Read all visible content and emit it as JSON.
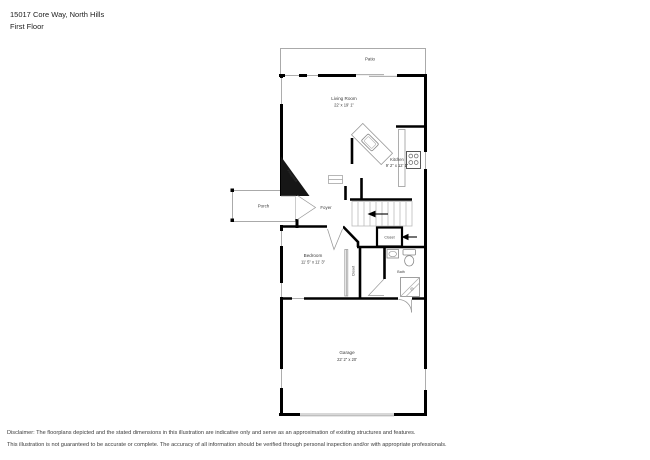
{
  "header": {
    "address": "15017 Core Way, North Hills",
    "floor": "First Floor"
  },
  "rooms": {
    "patio": {
      "label": "Patio"
    },
    "living_room": {
      "label": "Living Room",
      "dims": "22' x 19' 1\""
    },
    "kitchen": {
      "label": "Kitchen",
      "dims": "9' 2\" x 12' 1\""
    },
    "porch": {
      "label": "Porch"
    },
    "foyer": {
      "label": "Foyer"
    },
    "fireplace": {
      "label": "Fireplace"
    },
    "stair_closet": {
      "label": "Closet"
    },
    "bedroom": {
      "label": "Bedroom",
      "dims": "11' 5\" x 11' 3\""
    },
    "bedroom_closet": {
      "label": "Closet"
    },
    "bath": {
      "label": "Bath"
    },
    "garage": {
      "label": "Garage",
      "dims": "22' 2\" x 20'"
    }
  },
  "disclaimer": {
    "line1": "Disclaimer: The floorplans depicted and the stated dimensions in this illustration are indicative only and serve as an approximation of existing structures and features.",
    "line2": "This illustration is not guaranteed to be accurate or complete. The accuracy of all information should be verified through personal inspection and/or with appropriate professionals."
  },
  "colors": {
    "wall": "#000000",
    "thin_line": "#999999",
    "label_text": "#3a3a3a",
    "background": "#ffffff"
  }
}
